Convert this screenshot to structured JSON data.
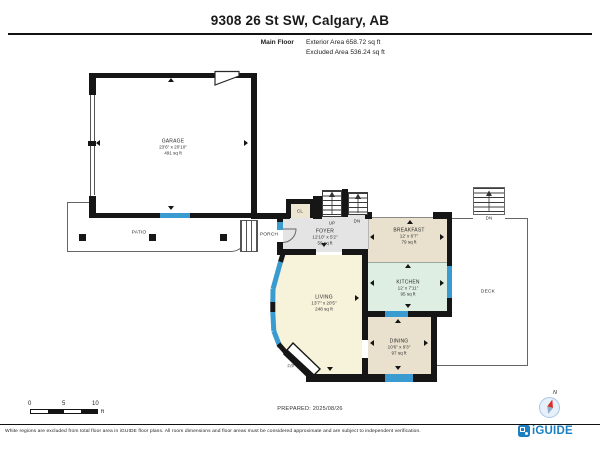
{
  "header": {
    "title": "9308 26 St SW, Calgary, AB",
    "floor_label": "Main Floor",
    "areas": [
      "Exterior Area 658.72 sq ft",
      "Excluded Area 536.24 sq ft"
    ]
  },
  "rooms": {
    "garage": {
      "name": "GARAGE",
      "dims": "23'6\" x 20'10\"",
      "area": "491 sq ft"
    },
    "foyer": {
      "name": "FOYER",
      "dims": "12'10\" x 5'2\"",
      "area": "59 sq ft"
    },
    "breakfast": {
      "name": "BREAKFAST",
      "dims": "12' x 6'7\"",
      "area": "79 sq ft"
    },
    "kitchen": {
      "name": "KITCHEN",
      "dims": "12' x 7'11\"",
      "area": "95 sq ft"
    },
    "living": {
      "name": "LIVING",
      "dims": "13'7\" x 20'5\"",
      "area": "248 sq ft"
    },
    "dining": {
      "name": "DINING",
      "dims": "10'6\" x 9'3\"",
      "area": "97 sq ft"
    },
    "closet": {
      "name": "CL"
    },
    "porch": {
      "name": "PORCH"
    },
    "patio": {
      "name": "PATIO"
    },
    "deck": {
      "name": "DECK"
    },
    "fireplace": {
      "name": "F/P"
    }
  },
  "stairs": {
    "up": "UP",
    "down_interior": "DN",
    "down_deck": "DN"
  },
  "scale_bar": {
    "ticks": [
      "0",
      "5",
      "10"
    ],
    "unit": "ft"
  },
  "prepared_label": "PREPARED: 2025/08/26",
  "compass_label": "N",
  "footer": {
    "disclaimer": "White regions are excluded from total floor area in iGUIDE floor plans. All room dimensions and floor areas must be considered approximate and are subject to independent verification.",
    "brand": "iGUIDE"
  },
  "colors": {
    "wall": "#161616",
    "window": "#3a9bd1",
    "living_fill": "#f7f2da",
    "tan_fill": "#e9e1cd",
    "kitchen_fill": "#dfeee3",
    "foyer_fill": "#e4e4e4",
    "closet_fill": "#ece5d1",
    "brand_blue": "#1b7fc4",
    "compass_red": "#d93025"
  }
}
